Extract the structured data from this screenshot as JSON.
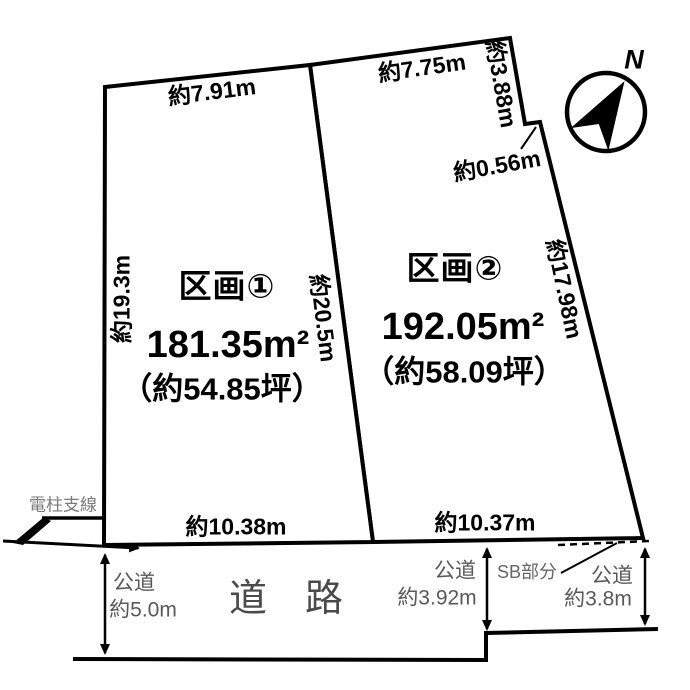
{
  "parcels": [
    {
      "name": "区画①",
      "area": "181.35m²",
      "tsubo": "（約54.85坪）"
    },
    {
      "name": "区画②",
      "area": "192.05m²",
      "tsubo": "（約58.09坪）"
    }
  ],
  "dimensions": {
    "p1_top": "約7.91m",
    "p1_left": "約19.3m",
    "p1_bottom": "約10.38m",
    "p2_top": "約7.75m",
    "p2_topright": "約3.88m",
    "p2_notch": "約0.56m",
    "p2_right": "約17.98m",
    "p2_bottom": "約10.37m",
    "divider": "約20.5m"
  },
  "road": {
    "label": "道　路",
    "left": {
      "type": "公道",
      "width": "約5.0m"
    },
    "center": {
      "type": "公道",
      "width": "約3.92m"
    },
    "right": {
      "type": "公道",
      "width": "約3.8m"
    }
  },
  "notes": {
    "pole": "電柱支線",
    "setback": "SB部分"
  },
  "compass": {
    "label": "N"
  },
  "colors": {
    "line": "#000000",
    "gray_label": "#595959"
  }
}
